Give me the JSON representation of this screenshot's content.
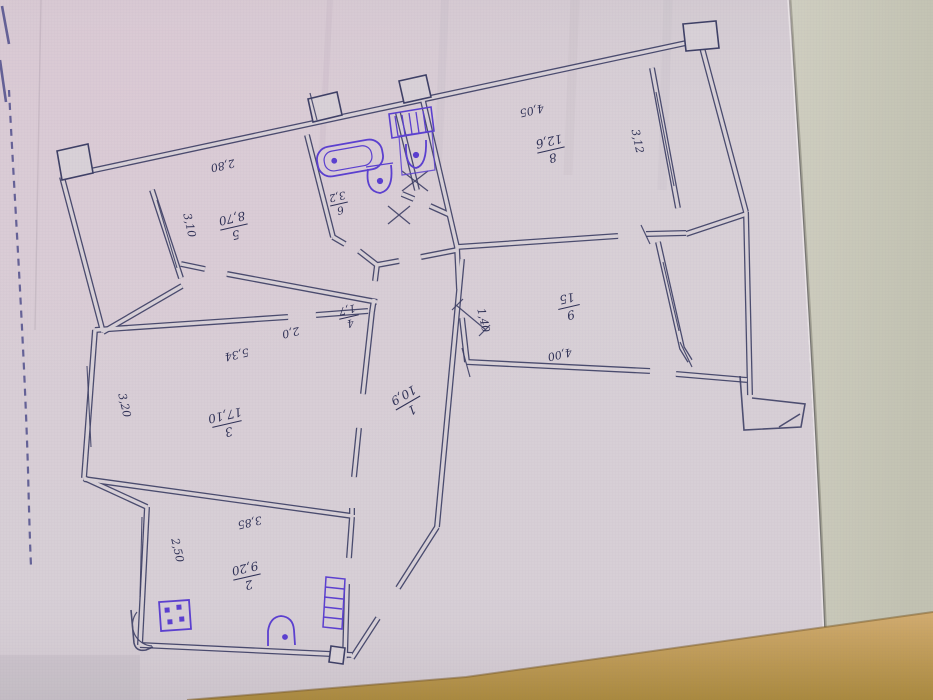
{
  "plan": {
    "rooms": [
      {
        "id": "corridor",
        "num": "1",
        "area": "10,9"
      },
      {
        "id": "kitchen",
        "num": "2",
        "area": "9,20"
      },
      {
        "id": "living",
        "num": "3",
        "area": "17,10"
      },
      {
        "id": "closet",
        "num": "4",
        "area": "1,7"
      },
      {
        "id": "bedroom5",
        "num": "5",
        "area": "8,70"
      },
      {
        "id": "bathroom",
        "num": "6",
        "area": "3,2"
      },
      {
        "id": "room8",
        "num": "8",
        "area": "12,6"
      },
      {
        "id": "room9",
        "num": "9",
        "area": "15"
      }
    ],
    "dimensions": {
      "d280": "2,80",
      "d310": "3,10",
      "d405": "4,05",
      "d312": "3,12",
      "d400": "4,00",
      "d140": "1,40",
      "d534": "5,34",
      "d320": "3,20",
      "d385": "3,85",
      "d250": "2,50",
      "d20": "2,0"
    },
    "colors": {
      "ink": "#3e4066",
      "fixture": "#5b3fd0",
      "paper": "#d7cfd6",
      "background": "#c9c9b9",
      "desk": "#c2a061"
    }
  }
}
